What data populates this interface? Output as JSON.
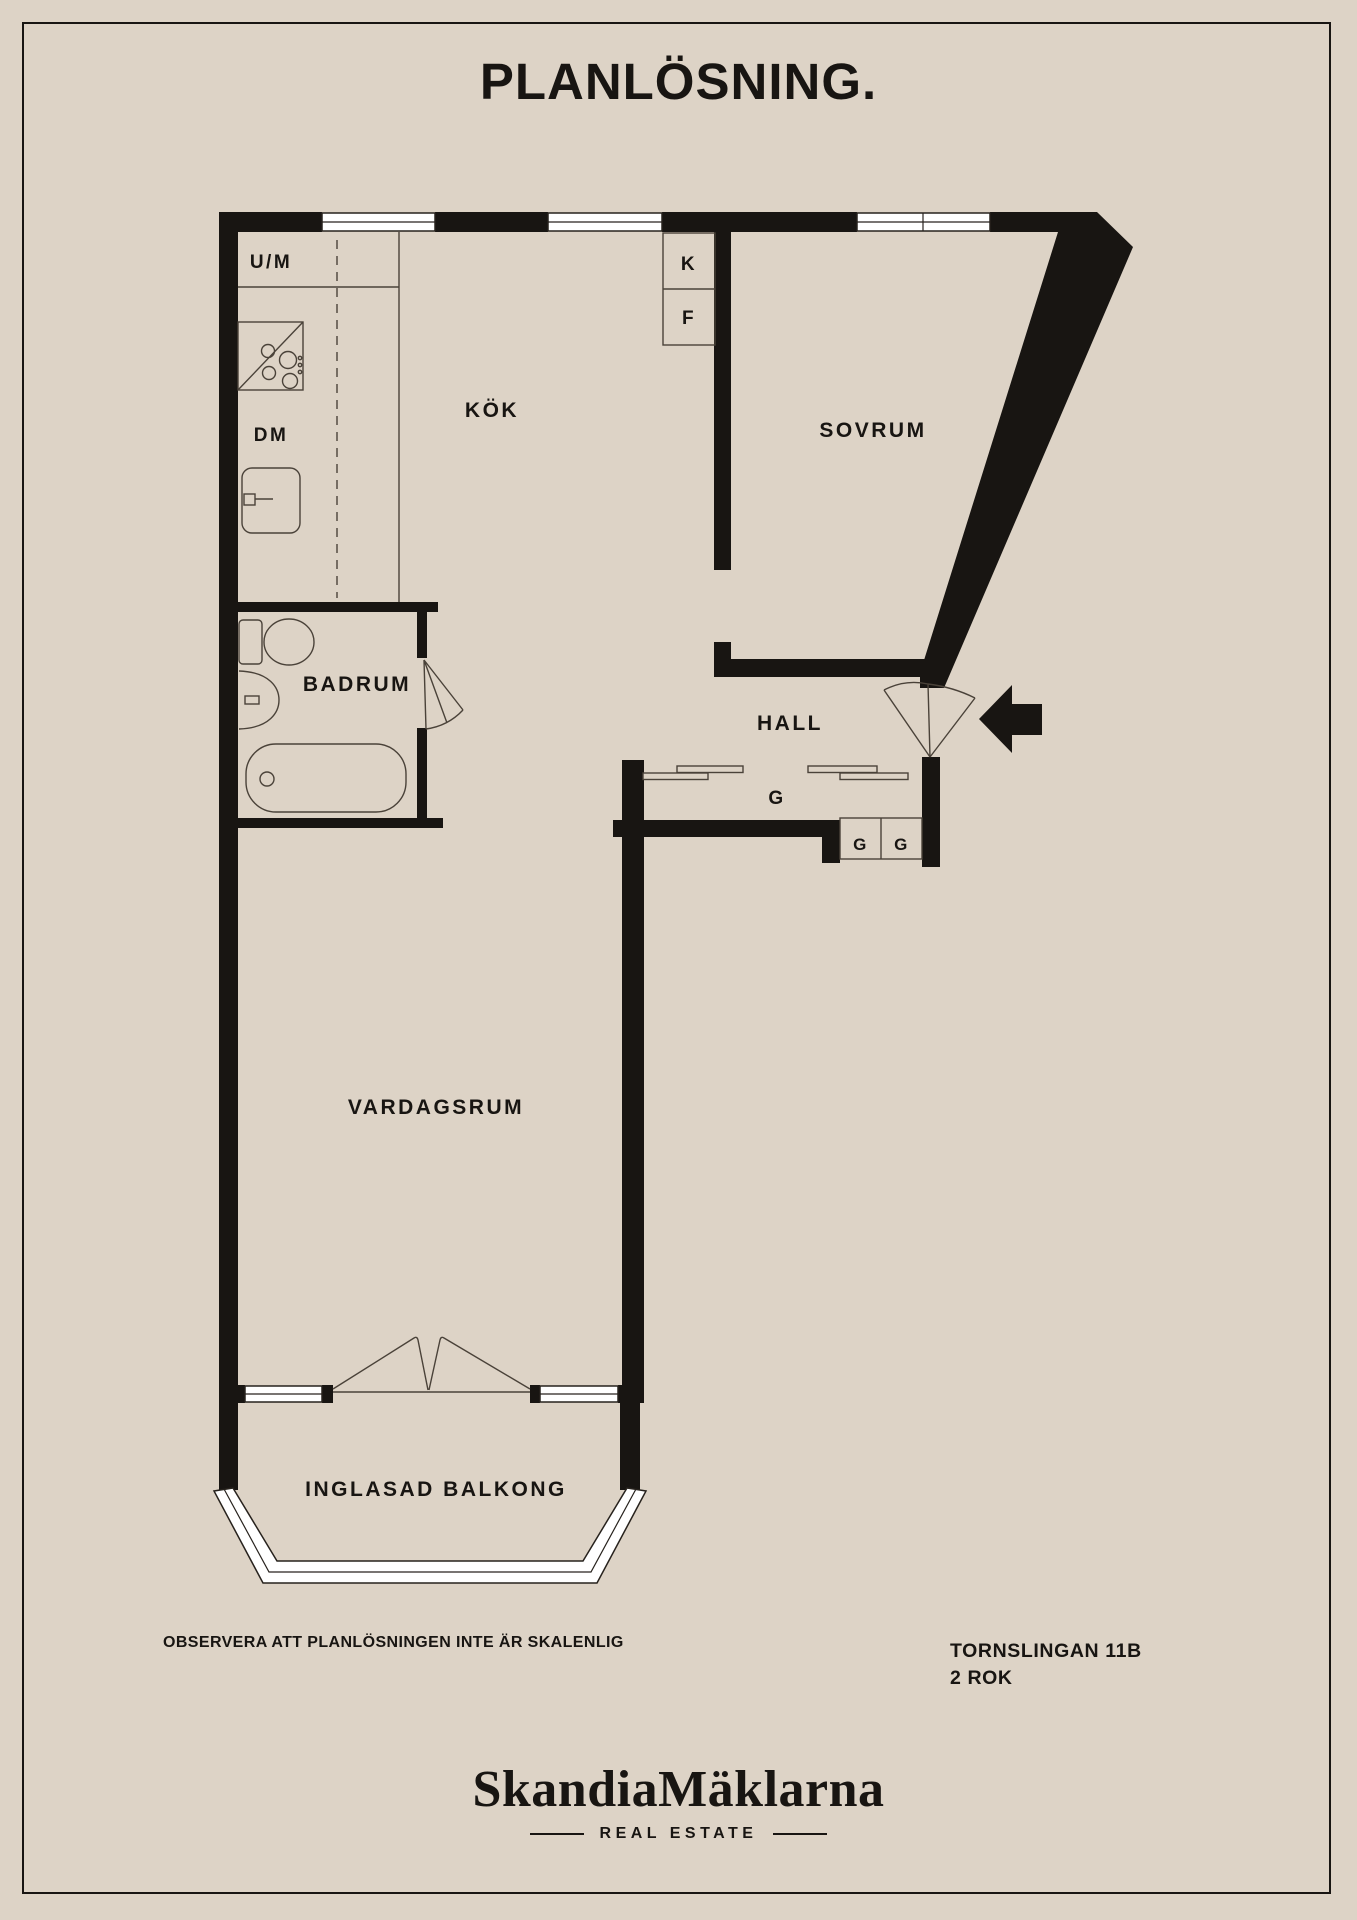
{
  "title": "PLANLÖSNING.",
  "rooms": {
    "kok": "KÖK",
    "sovrum": "SOVRUM",
    "badrum": "BADRUM",
    "hall": "HALL",
    "vardagsrum": "VARDAGSRUM",
    "balkong": "INGLASAD BALKONG"
  },
  "appliances": {
    "um": "U/M",
    "dm": "DM",
    "k": "K",
    "f": "F",
    "hall_closet": "G",
    "gg": [
      "G",
      "G"
    ]
  },
  "footer": {
    "disclaimer": "OBSERVERA ATT PLANLÖSNINGEN INTE ÄR SKALENLIG",
    "address": "TORNSLINGAN 11B",
    "size": "2 ROK"
  },
  "logo": {
    "name": "SkandiaMäklarna",
    "tagline": "REAL ESTATE"
  },
  "colors": {
    "background": "#ddd3c6",
    "ink": "#181512",
    "line": "#4a4239",
    "window": "#ffffff"
  }
}
